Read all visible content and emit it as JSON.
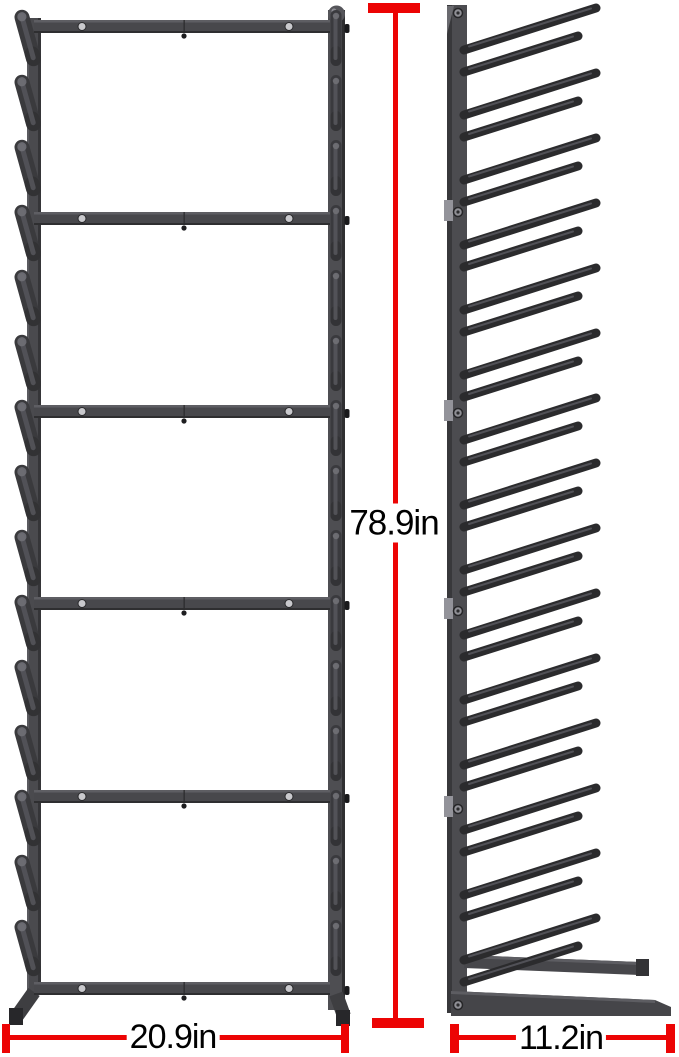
{
  "figure": {
    "type": "product-dimension-diagram",
    "subject": "vertical weight bar storage rack, front view and side view",
    "dimensions": {
      "height": {
        "label": "78.9in",
        "value": 78.9,
        "unit": "in"
      },
      "width": {
        "label": "20.9in",
        "value": 20.9,
        "unit": "in"
      },
      "depth": {
        "label": "11.2in",
        "value": 11.2,
        "unit": "in"
      }
    },
    "colors": {
      "dimension_red": "#ec0404",
      "label_text": "#000000",
      "frame_gray": "#4a4a4e",
      "frame_dark": "#2b2b2d",
      "frame_light": "#93939a",
      "background": "#ffffff"
    },
    "structure": {
      "front_view": {
        "crossbars": 6,
        "peg_levels_left": 15,
        "peg_levels_right": 15,
        "screw_holes_per_crossbar": 2
      },
      "side_view": {
        "rod_pairs": 15,
        "joint_tabs": 4,
        "post_screw_holes": 6,
        "foot_beams": 2
      }
    }
  }
}
